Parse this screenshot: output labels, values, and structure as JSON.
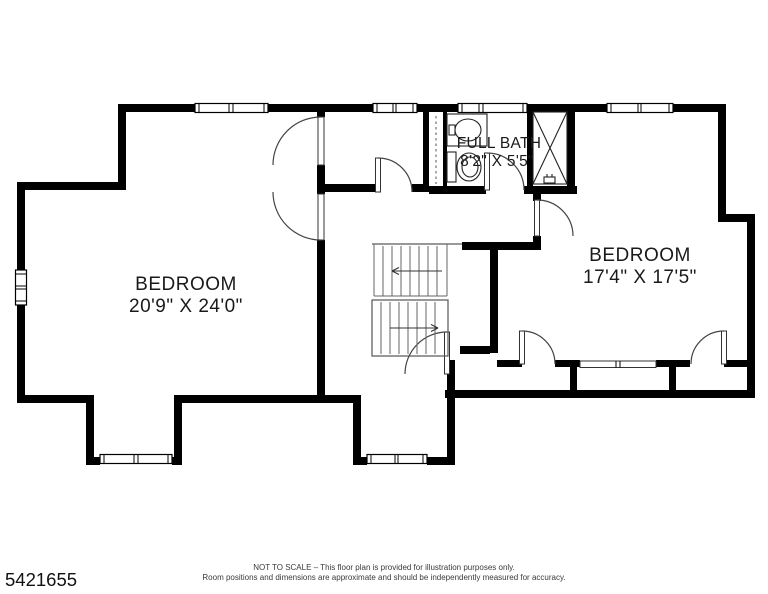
{
  "canvas": {
    "width": 768,
    "height": 594,
    "background": "#ffffff",
    "wall_color": "#000000"
  },
  "rooms": {
    "bedroom_left": {
      "label": "BEDROOM",
      "dimensions": "20'9\" X 24'0\""
    },
    "full_bath": {
      "label": "FULL BATH",
      "dimensions": "8'2\" X 5'5\""
    },
    "bedroom_right": {
      "label": "BEDROOM",
      "dimensions": "17'4\" X 17'5\""
    }
  },
  "footer": {
    "listing_number": "5421655",
    "disclaimer_line1": "NOT TO SCALE – This floor plan is provided for illustration purposes only.",
    "disclaimer_line2": "Room positions and dimensions are approximate and should be independently measured for accuracy."
  }
}
